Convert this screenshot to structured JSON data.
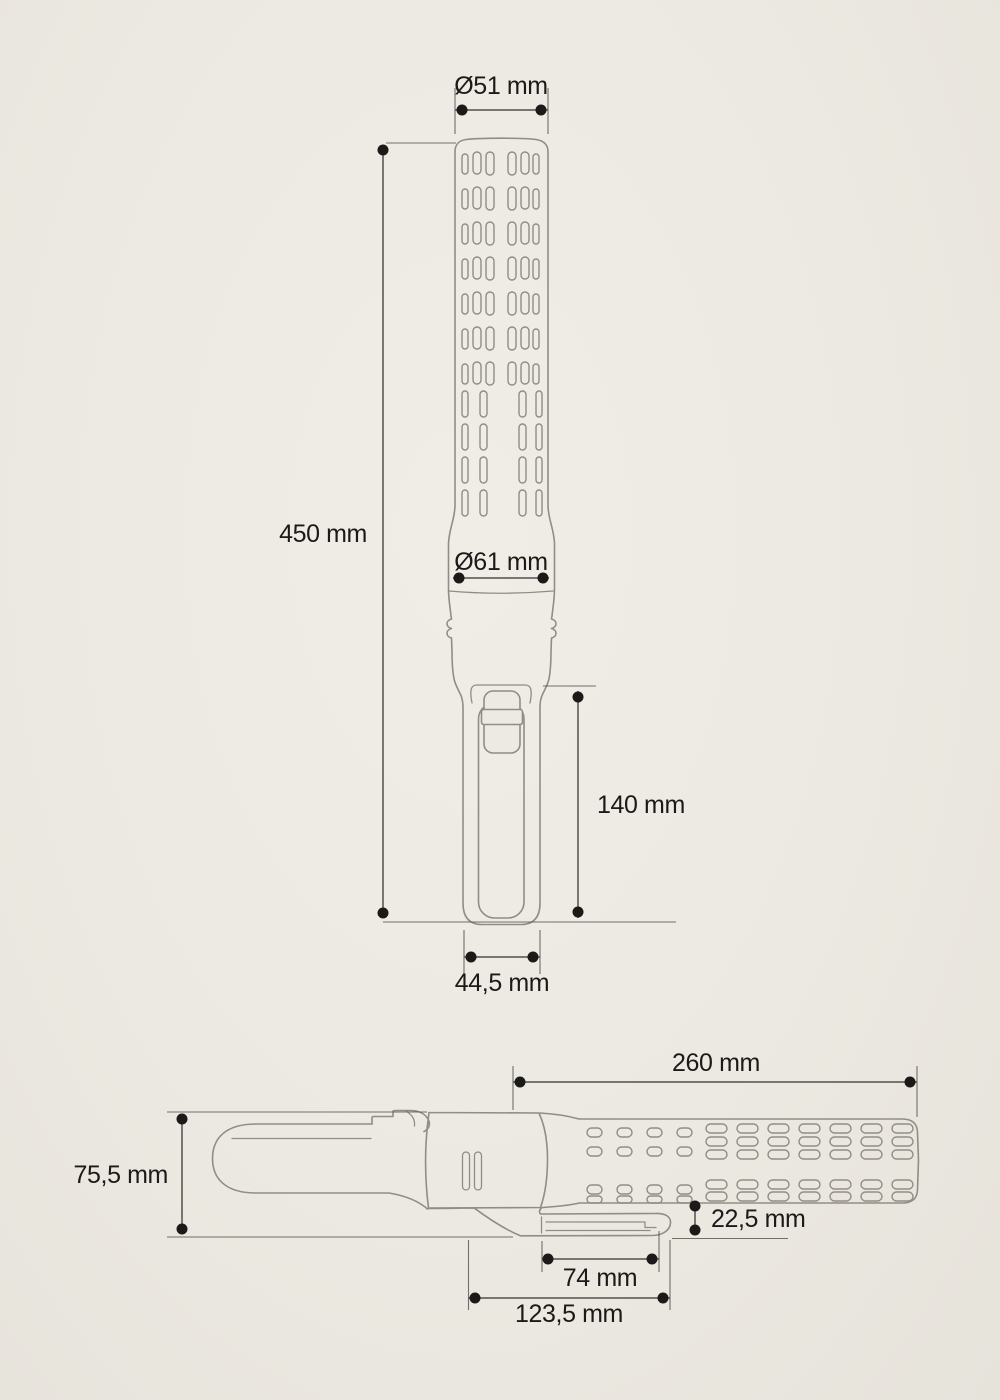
{
  "colors": {
    "background": "#edeae3",
    "outline": "#8f8d86",
    "dimension": "#51504b",
    "text": "#1b1a18"
  },
  "front_view": {
    "head_diameter": "Ø51 mm",
    "overall_length": "450 mm",
    "body_diameter": "Ø61 mm",
    "handle_length": "140 mm",
    "handle_width": "44,5 mm"
  },
  "side_view": {
    "barrel_length": "260 mm",
    "overall_height": "75,5 mm",
    "clip_clearance": "22,5 mm",
    "clip_opening": "74 mm",
    "clip_length": "123,5 mm"
  }
}
